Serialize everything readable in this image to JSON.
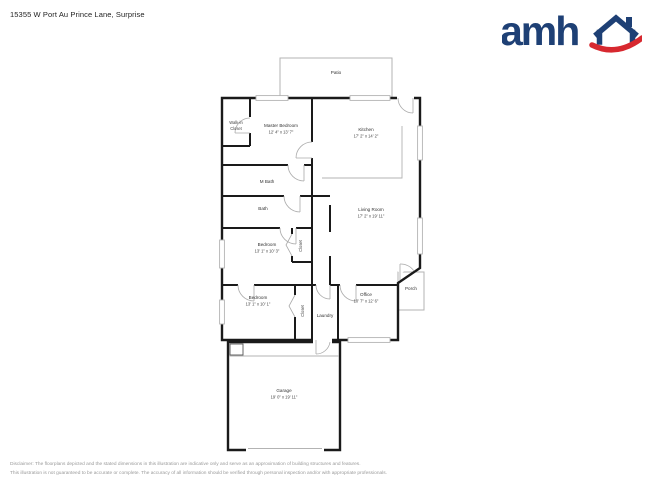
{
  "header": {
    "address": "15355 W Port Au Prince Lane, Surprise"
  },
  "logo": {
    "text": "amh",
    "brand_blue": "#1e4075",
    "brand_red": "#d7282f"
  },
  "plan": {
    "wall_color": "#1a1a1a",
    "accent_gray": "#b3b3b3",
    "rooms": {
      "patio": {
        "name": "Patio"
      },
      "walk_in_closet": {
        "line1": "Walk-in",
        "line2": "Closet"
      },
      "master_bedroom": {
        "name": "Master Bedroom",
        "dims": "12' 4\" x 13' 7\""
      },
      "kitchen": {
        "name": "Kitchen",
        "dims": "17' 2\" x 14' 2\""
      },
      "m_bath": {
        "name": "M Bath"
      },
      "bath": {
        "name": "Bath"
      },
      "living_room": {
        "name": "Living Room",
        "dims": "17' 2\" x 19' 11\""
      },
      "bedroom_1": {
        "name": "Bedroom",
        "dims": "13' 1\" x 10' 3\""
      },
      "closet_1": {
        "name": "Closet"
      },
      "bedroom_2": {
        "name": "Bedroom",
        "dims": "13' 1\" x 10' 1\""
      },
      "closet_2": {
        "name": "Closet"
      },
      "laundry": {
        "name": "Laundry"
      },
      "office": {
        "name": "Office",
        "dims": "10' 7\" x 12' 6\""
      },
      "porch": {
        "name": "Porch"
      },
      "garage": {
        "name": "Garage",
        "dims": "19' 0\" x 19' 11\""
      }
    }
  },
  "footer": {
    "line1": "Disclaimer: The floorplans depicted and the stated dimensions in this illustration are indicative only and serve as an approximation of building structures and features.",
    "line2": "This illustration is not guaranteed to be accurate or complete. The accuracy of all information should be verified through personal inspection and/or with appropriate professionals."
  }
}
